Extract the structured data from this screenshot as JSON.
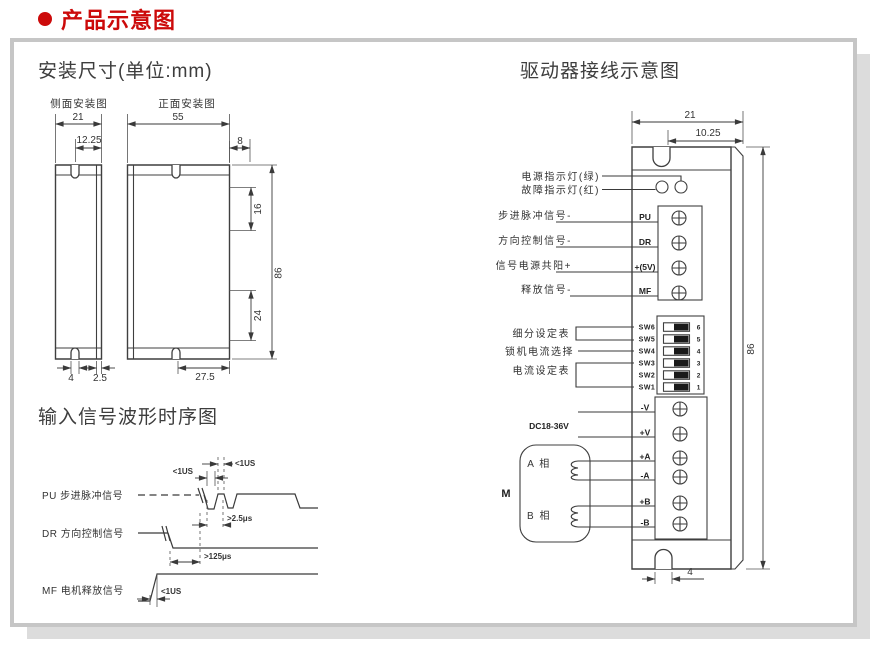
{
  "header": {
    "title": "产品示意图"
  },
  "mounting": {
    "title": "安装尺寸(单位:mm)",
    "side_view_label": "侧面安装图",
    "front_view_label": "正面安装图",
    "dims": {
      "side_width": "21",
      "side_notch_offset": "12.25",
      "front_width": "55",
      "tab_depth": "8",
      "slot_top": "16",
      "slot_bottom": "24",
      "height": "86",
      "notch_width": "4",
      "wall_thickness": "2.5",
      "front_notch_offset": "27.5"
    }
  },
  "wiring": {
    "title": "驱动器接线示意图",
    "dims": {
      "width": "21",
      "notch_offset": "10.25",
      "height": "86",
      "notch_width": "4"
    },
    "leds": {
      "power": "电源指示灯(绿)",
      "fault": "故障指示灯(红)"
    },
    "signals": [
      {
        "label": "步进脉冲信号-",
        "pin": "PU"
      },
      {
        "label": "方向控制信号-",
        "pin": "DR"
      },
      {
        "label": "信号电源共阳+",
        "pin": "+(5V)"
      },
      {
        "label": "释放信号-",
        "pin": "MF"
      }
    ],
    "dip": {
      "subdivision_label": "细分设定表",
      "lock_current_label": "锁机电流选择",
      "current_label": "电流设定表",
      "switches": [
        {
          "name": "SW6",
          "num": "6"
        },
        {
          "name": "SW5",
          "num": "5"
        },
        {
          "name": "SW4",
          "num": "4"
        },
        {
          "name": "SW3",
          "num": "3"
        },
        {
          "name": "SW2",
          "num": "2"
        },
        {
          "name": "SW1",
          "num": "1"
        }
      ]
    },
    "power": {
      "supply_label": "DC18-36V",
      "pins": [
        "-V",
        "+V"
      ]
    },
    "motor": {
      "label": "M",
      "phase_a": "A 相",
      "phase_b": "B 相",
      "pins": [
        "+A",
        "-A",
        "+B",
        "-B"
      ]
    }
  },
  "timing": {
    "title": "输入信号波形时序图",
    "signals": [
      {
        "name": "PU 步进脉冲信号"
      },
      {
        "name": "DR 方向控制信号"
      },
      {
        "name": "MF 电机释放信号"
      }
    ],
    "annotations": {
      "pulse_high": "<1US",
      "pulse_low": "<1US",
      "period": ">2.5μs",
      "dir_setup": ">125μs",
      "mf_delay": "<1US"
    }
  },
  "colors": {
    "accent": "#cc0a0a",
    "line": "#3a3a3a",
    "panel_border": "#c6c6c6",
    "shadow": "#dcdcdc"
  }
}
